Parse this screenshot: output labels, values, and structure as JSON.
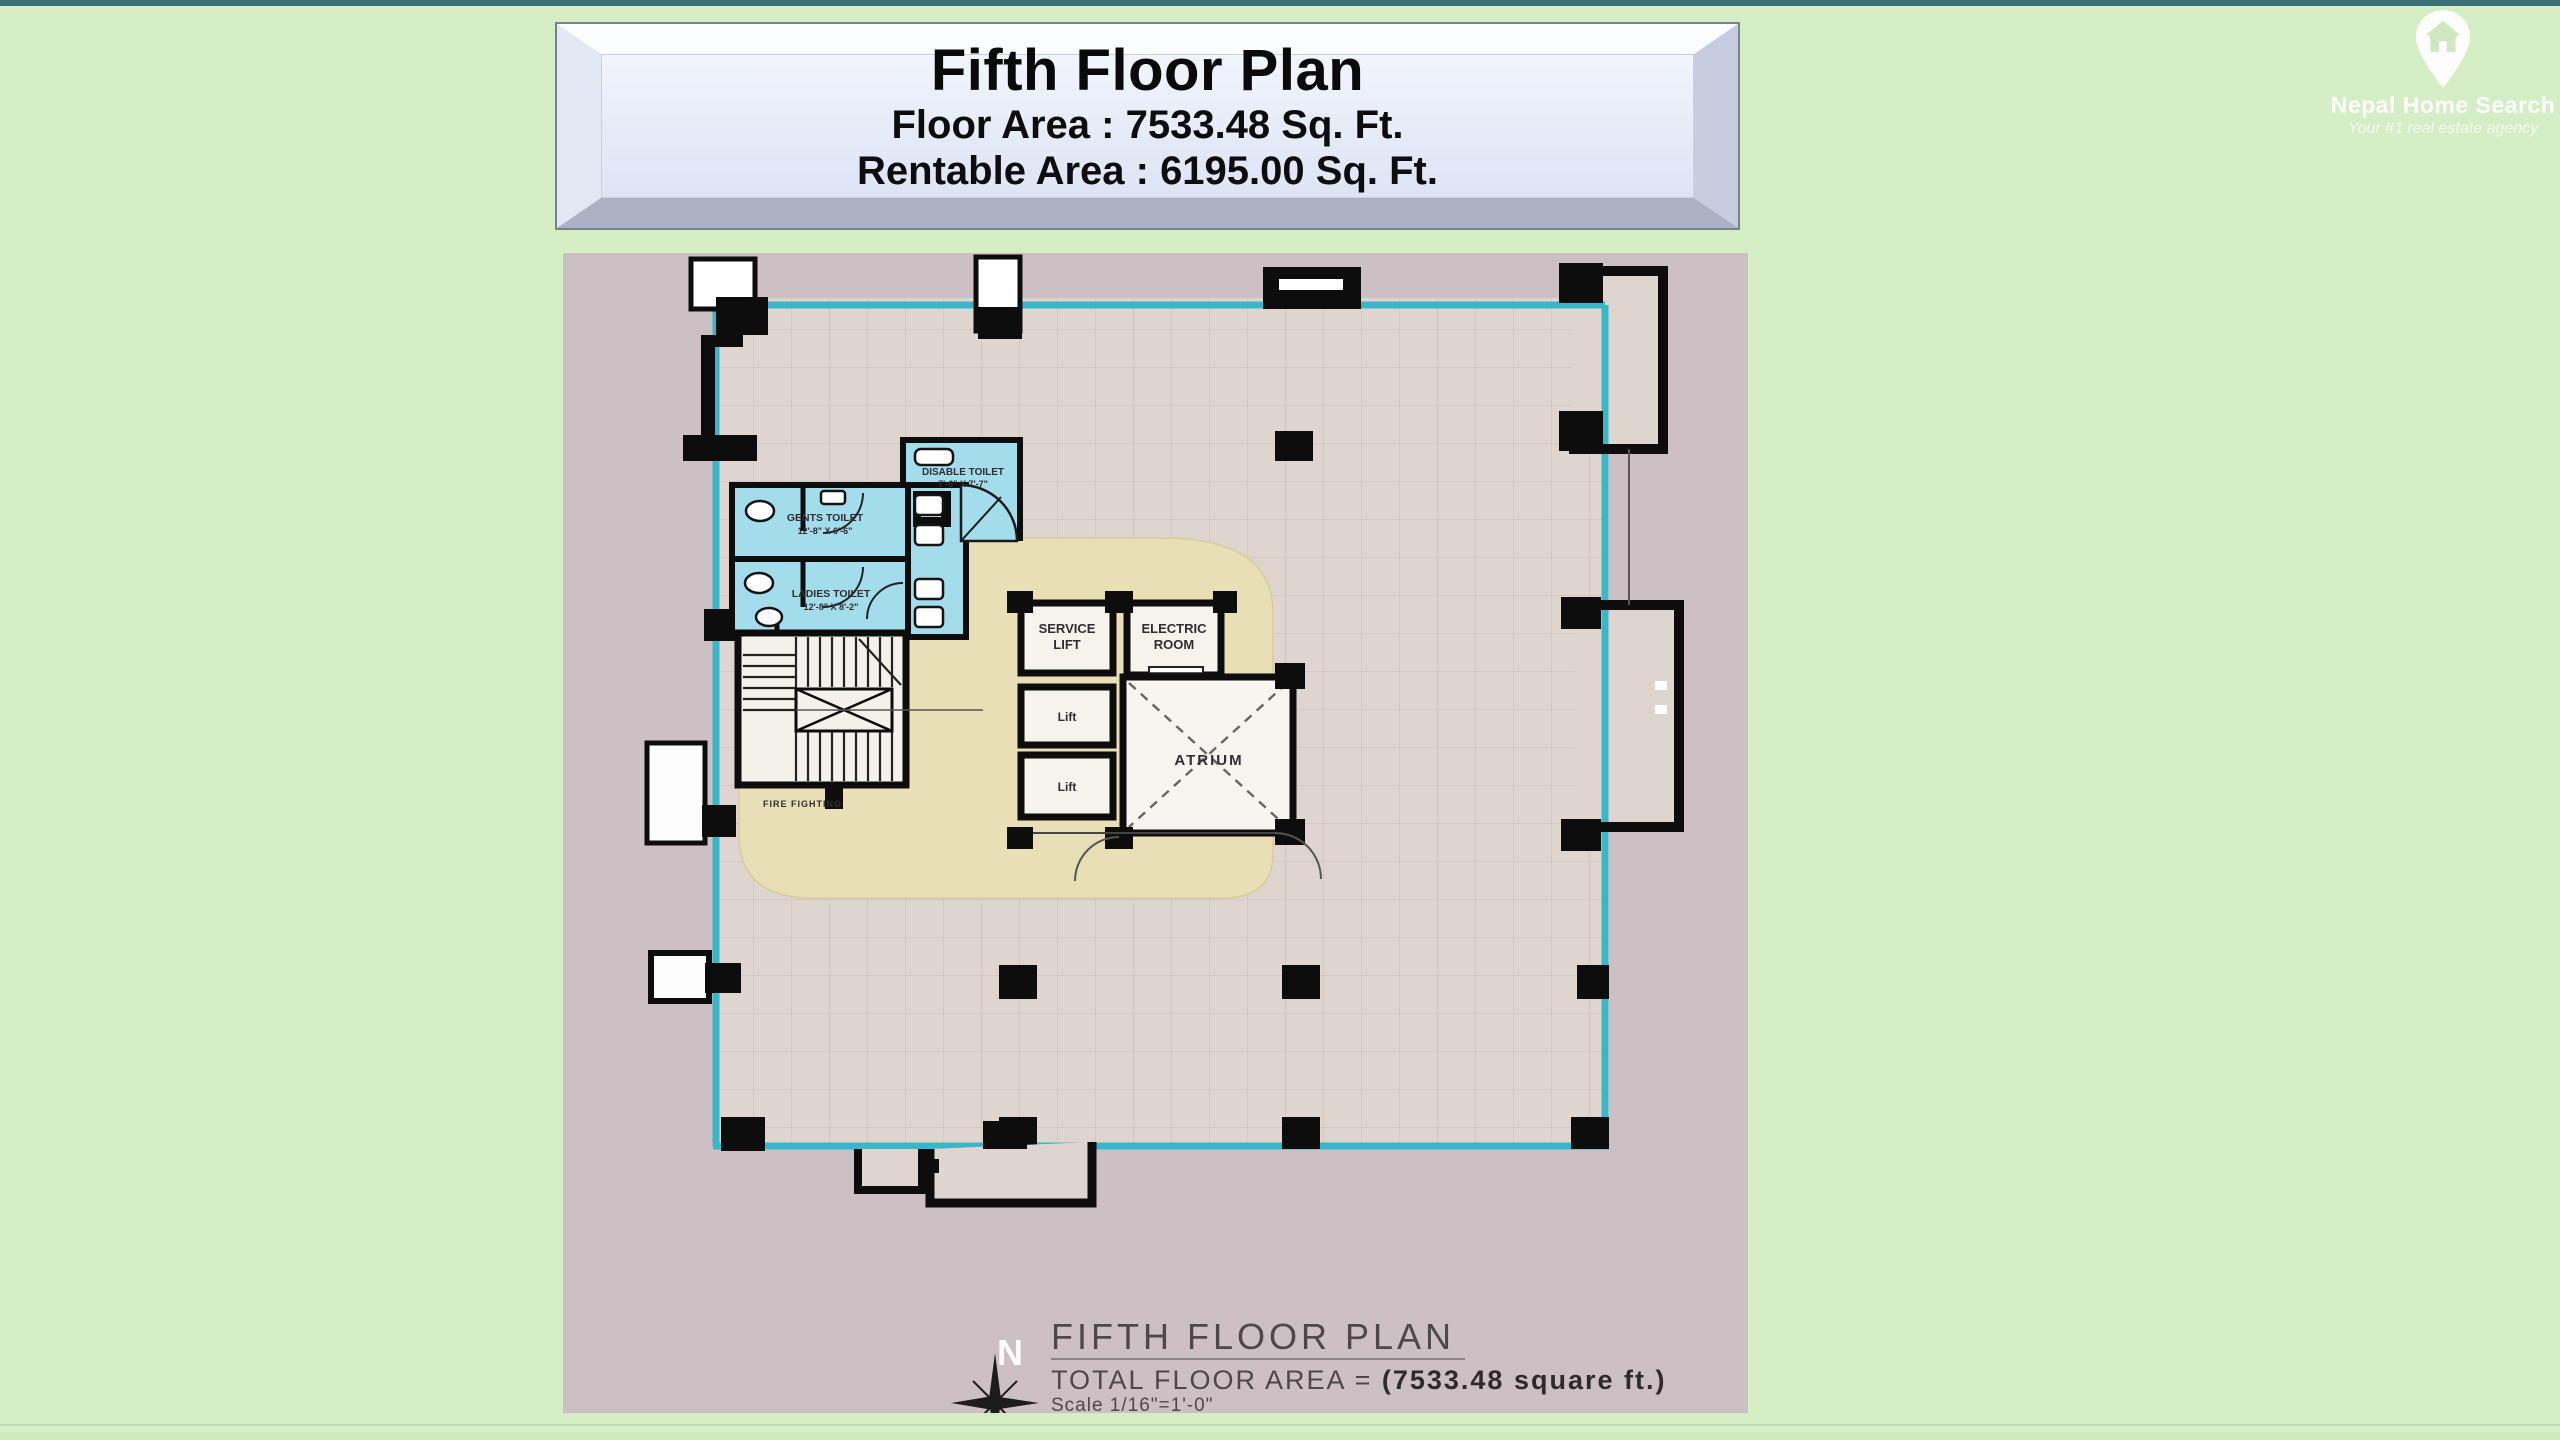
{
  "page": {
    "background": "#d6eec6",
    "top_strip_color": "#3b6f78"
  },
  "header_box": {
    "title": "Fifth Floor Plan",
    "floor_area_line": "Floor Area : 7533.48 Sq. Ft.",
    "rentable_area_line": "Rentable Area : 6195.00 Sq. Ft."
  },
  "logo": {
    "name": "Nepal Home Search",
    "tagline": "Your #1 real estate agency",
    "icon": "house-map-pin-icon"
  },
  "plan": {
    "colors": {
      "canvas": "#cdc0c5",
      "floor": "#ded5cf",
      "corridor": "#e9dfb6",
      "wet_area": "#a3dcea",
      "glass_wall": "#3ab6c9",
      "wall": "#0d0d0d"
    },
    "rooms": {
      "disable_toilet": {
        "name": "DISABLE TOILET",
        "dims": "7'-6\" X 7'-7\""
      },
      "gents_toilet": {
        "name": "GENTS TOILET",
        "dims": "12'-8\" X 6'-6\""
      },
      "ladies_toilet": {
        "name": "LADIES TOILET",
        "dims": "12'-8\" X 8'-2\""
      },
      "service_lift": {
        "line1": "SERVICE",
        "line2": "LIFT"
      },
      "electric_room": {
        "line1": "ELECTRIC",
        "line2": "ROOM"
      },
      "lift_upper": "Lift",
      "lift_lower": "Lift",
      "atrium": "ATRIUM",
      "fire_fighting": "FIRE FIGHTING"
    },
    "caption": {
      "north_letter": "N",
      "title": "FIFTH FLOOR PLAN",
      "area_prefix": "TOTAL FLOOR  AREA = ",
      "area_value": "(7533.48  square ft.)",
      "scale": "Scale 1/16\"=1'-0\""
    }
  }
}
